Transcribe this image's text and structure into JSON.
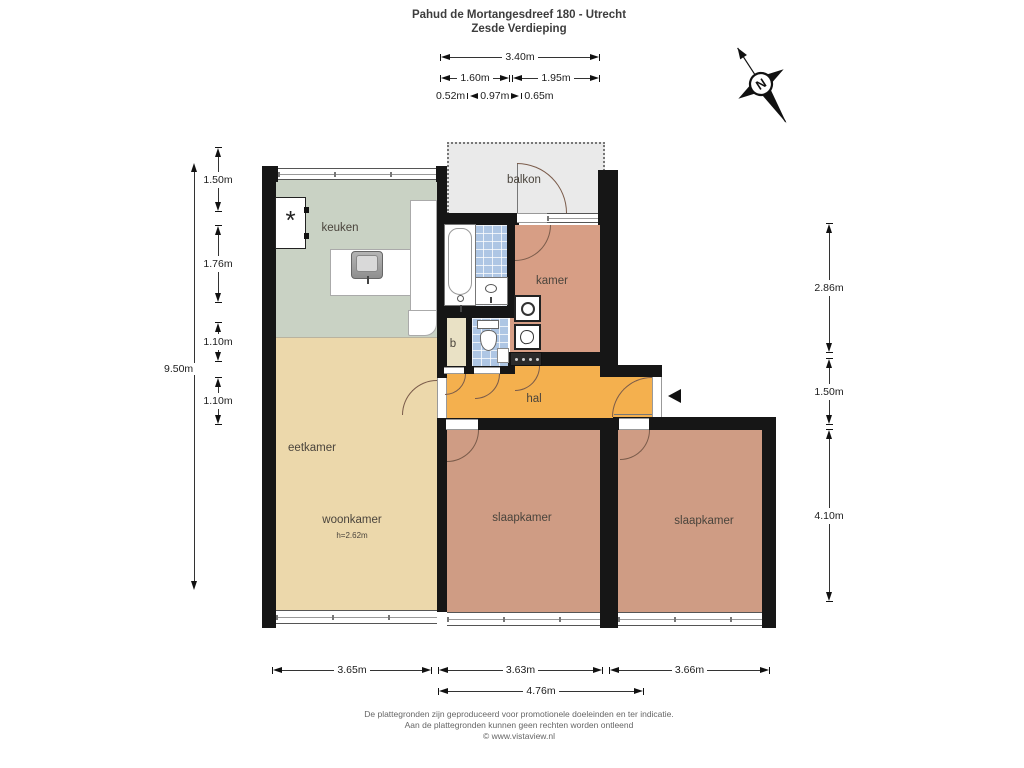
{
  "title": {
    "line1": "Pahud de Mortangesdreef 180 - Utrecht",
    "line2": "Zesde Verdieping"
  },
  "compass": {
    "north_label": "N"
  },
  "rooms": {
    "balkon": {
      "label": "balkon"
    },
    "keuken": {
      "label": "keuken"
    },
    "kamer": {
      "label": "kamer"
    },
    "berging": {
      "label": "b"
    },
    "hal": {
      "label": "hal"
    },
    "eetkamer": {
      "label": "eetkamer"
    },
    "woonkamer": {
      "label": "woonkamer",
      "height_note": "h=2.62m"
    },
    "slaapkamer_mid": {
      "label": "slaapkamer"
    },
    "slaapkamer_right": {
      "label": "slaapkamer"
    }
  },
  "fixtures": {
    "fridge_symbol": "*"
  },
  "dimensions": [
    {
      "id": "top-340",
      "type": "h",
      "label": "3.40m",
      "x1": 440,
      "x2": 600,
      "y": 57
    },
    {
      "id": "top-160",
      "type": "h",
      "label": "1.60m",
      "x1": 440,
      "x2": 510,
      "y": 78
    },
    {
      "id": "top-195",
      "type": "h",
      "label": "1.95m",
      "x1": 512,
      "x2": 600,
      "y": 78
    },
    {
      "id": "left-150",
      "type": "v",
      "label": "1.50m",
      "x": 218,
      "y1": 147,
      "y2": 212
    },
    {
      "id": "left-176",
      "type": "v",
      "label": "1.76m",
      "x": 218,
      "y1": 225,
      "y2": 303
    },
    {
      "id": "left-110a",
      "type": "v",
      "label": "1.10m",
      "x": 218,
      "y1": 322,
      "y2": 362
    },
    {
      "id": "left-110b",
      "type": "v",
      "label": "1.10m",
      "x": 218,
      "y1": 377,
      "y2": 425
    },
    {
      "id": "left-950",
      "type": "vside",
      "label": "9.50m",
      "x": 194,
      "y1": 163,
      "y2": 590,
      "labelx": 162,
      "labely": 363
    },
    {
      "id": "right-286",
      "type": "v",
      "label": "2.86m",
      "x": 829,
      "y1": 223,
      "y2": 353
    },
    {
      "id": "right-150",
      "type": "v",
      "label": "1.50m",
      "x": 829,
      "y1": 358,
      "y2": 425
    },
    {
      "id": "right-410",
      "type": "v",
      "label": "4.10m",
      "x": 829,
      "y1": 429,
      "y2": 602
    },
    {
      "id": "bottom-365",
      "type": "h",
      "label": "3.65m",
      "x1": 272,
      "x2": 432,
      "y": 670
    },
    {
      "id": "bottom-363",
      "type": "h",
      "label": "3.63m",
      "x1": 438,
      "x2": 603,
      "y": 670
    },
    {
      "id": "bottom-366",
      "type": "h",
      "label": "3.66m",
      "x1": 609,
      "x2": 770,
      "y": 670
    },
    {
      "id": "bottom-476",
      "type": "h",
      "label": "4.76m",
      "x1": 438,
      "x2": 644,
      "y": 691
    }
  ],
  "sub_dimensions": {
    "parts": [
      "0.52m",
      "0.97m",
      "0.65m"
    ]
  },
  "footer": {
    "line1": "De plattegronden zijn geproduceerd voor promotionele doeleinden en ter indicatie.",
    "line2": "Aan de plattegronden kunnen geen rechten worden ontleend",
    "line3": "© www.vistaview.nl"
  },
  "colors": {
    "wall": "#161616",
    "keuken_floor": "#c9d2c4",
    "living_floor": "#ecd8ab",
    "bedroom_floor": "#cf9c84",
    "kamer_floor": "#d79e85",
    "hal_floor": "#f4b04e",
    "balkon_floor": "#eaeaea",
    "berging_floor": "#e9e1c5",
    "tile_floor": "#aec6e4",
    "label_text": "#4a443c",
    "dim_text": "#1c1c1c",
    "title_text": "#3d3d3d",
    "footer_text": "#666666",
    "door_arc": "#7a5b4a"
  }
}
